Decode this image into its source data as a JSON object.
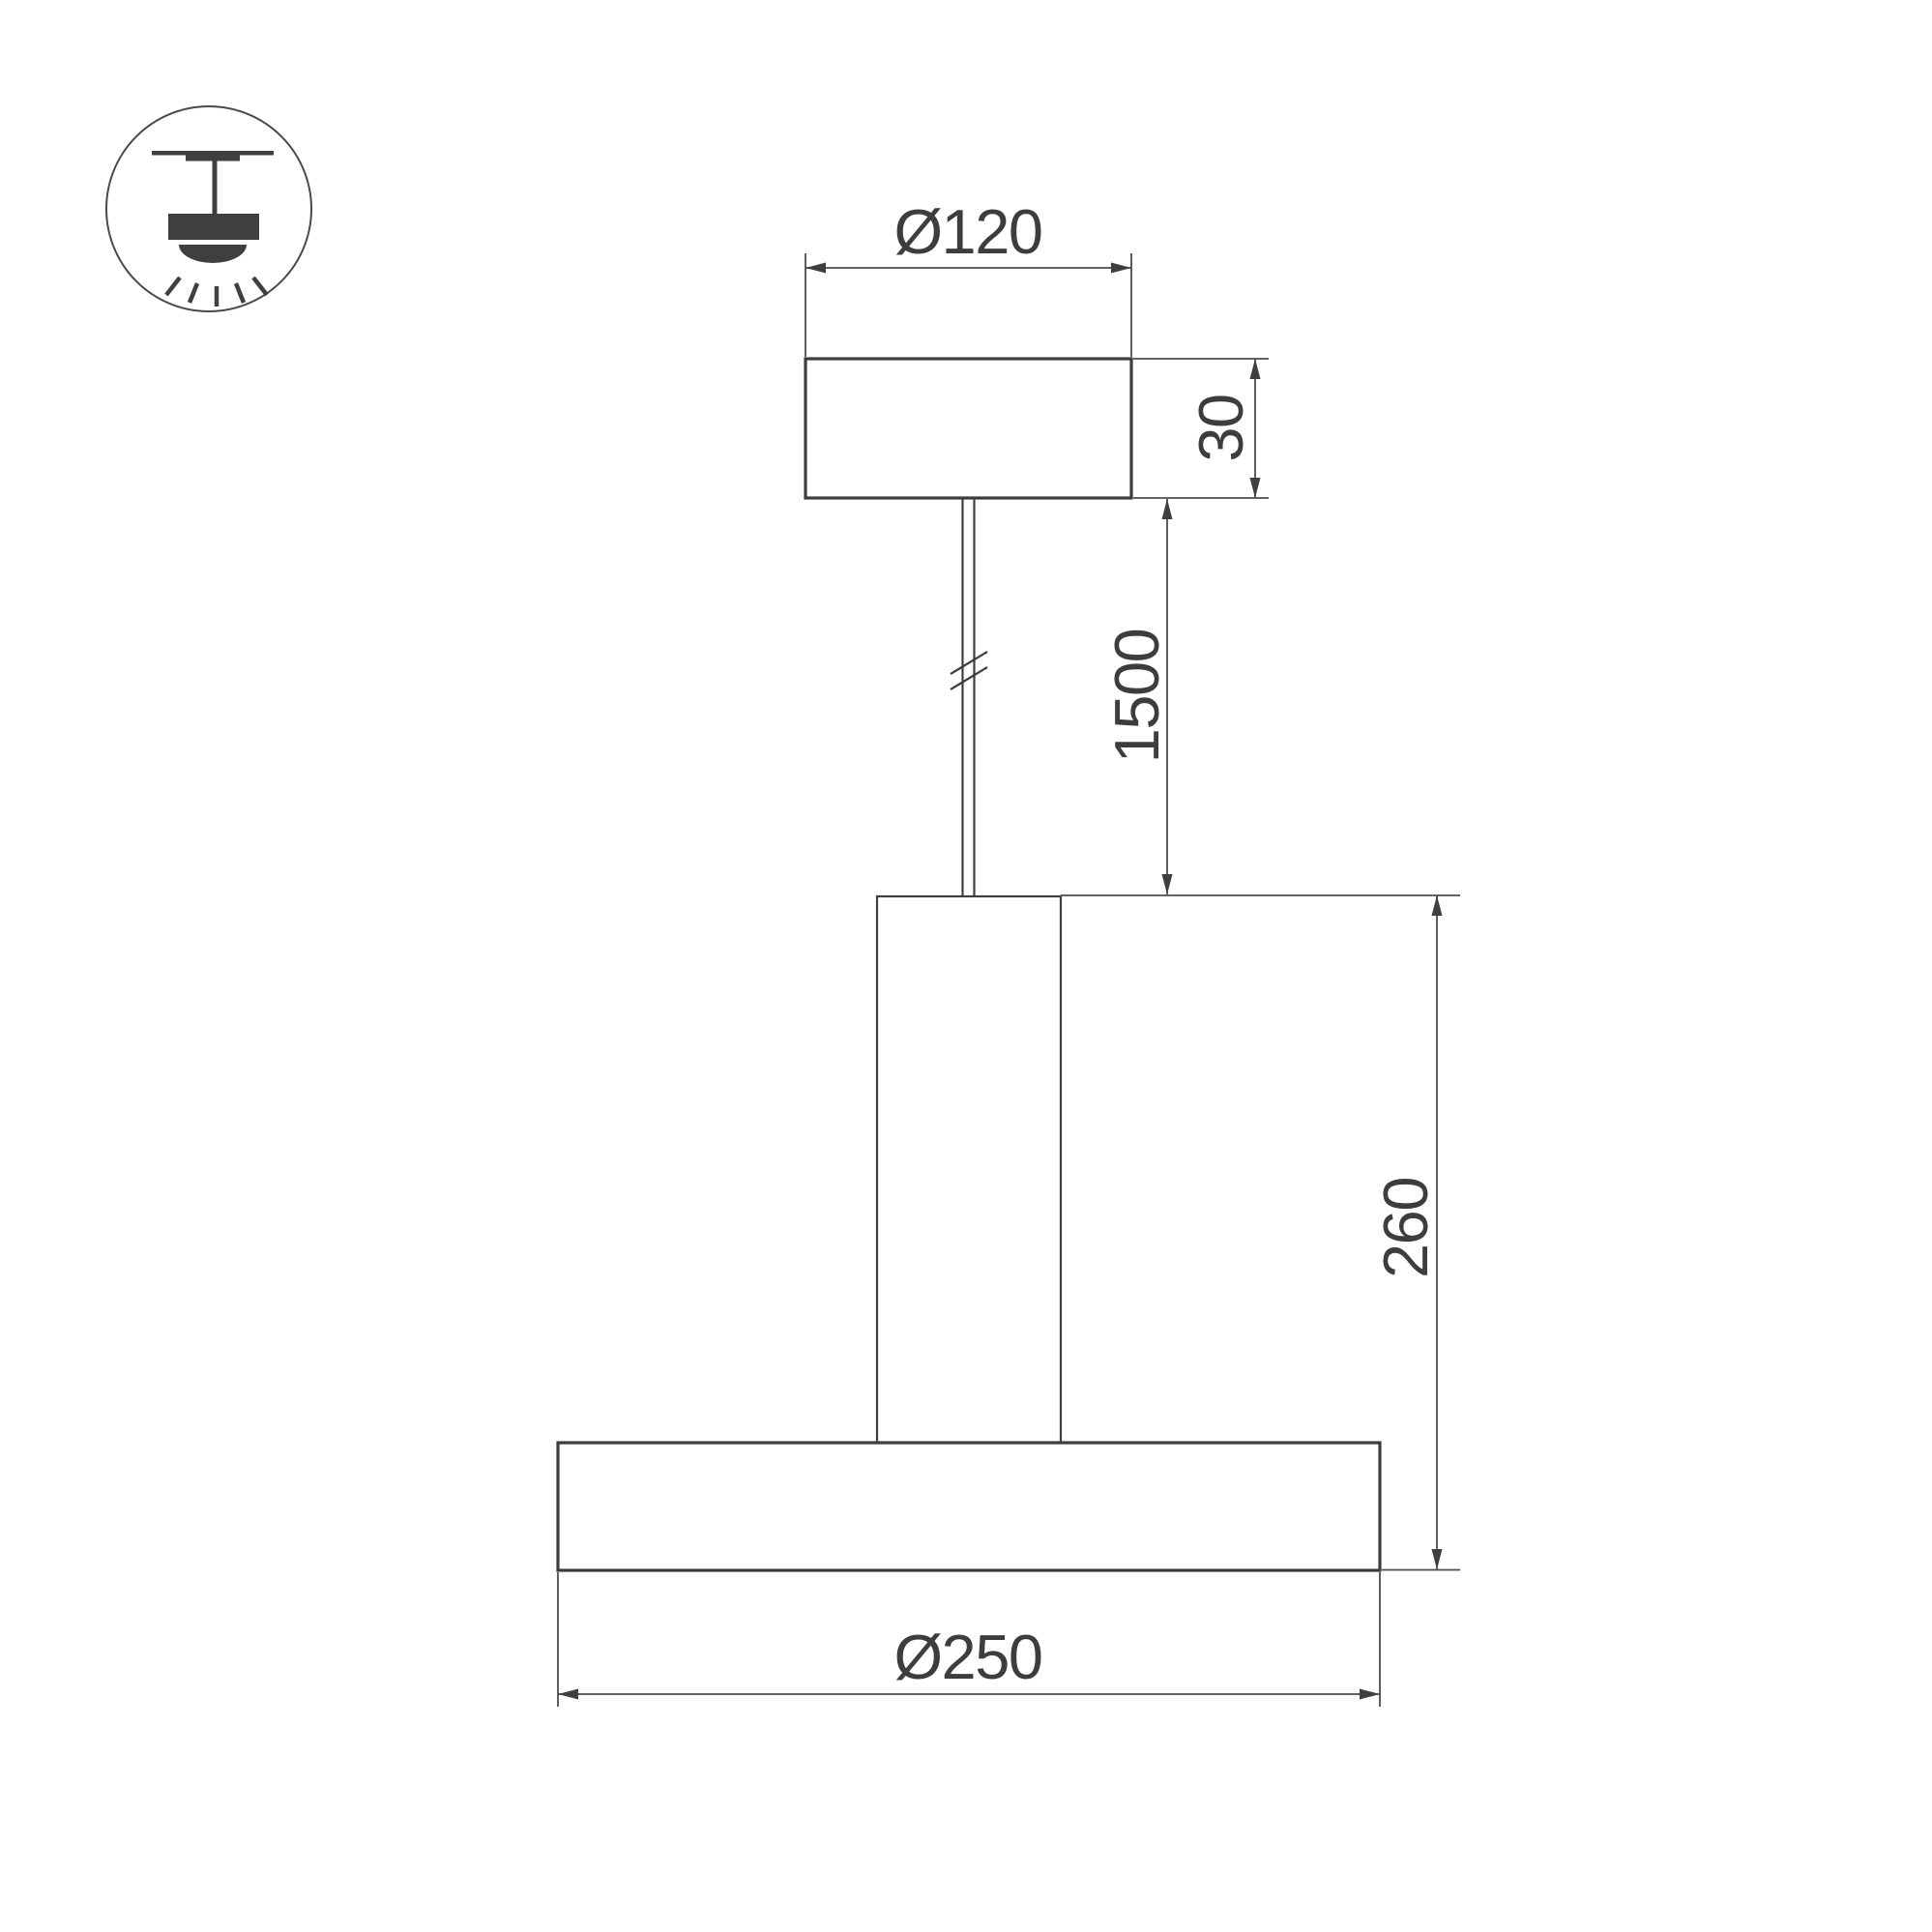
{
  "page": {
    "background": "#ffffff"
  },
  "icon": {
    "name": "pendant-lamp-ceiling-mount-icon"
  },
  "drawing": {
    "type": "technical-dimensional-drawing",
    "colors": {
      "outline": "#3c3c3c",
      "thin_line": "#4d4d4d",
      "text": "#3d3d3d",
      "background": "#ffffff"
    },
    "dimensions": {
      "canopy_diameter": {
        "label": "Ø120"
      },
      "canopy_height": {
        "label": "30"
      },
      "suspension_length": {
        "label": "1500"
      },
      "fixture_height": {
        "label": "260"
      },
      "shade_diameter": {
        "label": "Ø250"
      }
    }
  }
}
